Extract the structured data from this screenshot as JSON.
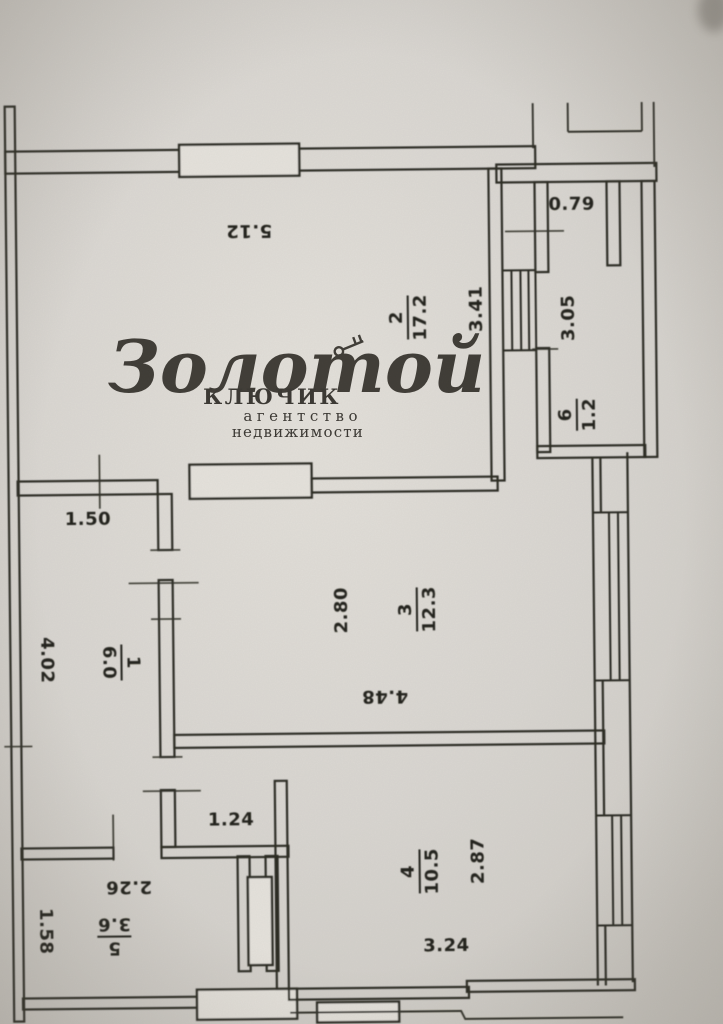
{
  "plan": {
    "rooms": [
      {
        "number": "1",
        "area": "6.0"
      },
      {
        "number": "2",
        "area": "17.2"
      },
      {
        "number": "3",
        "area": "12.3"
      },
      {
        "number": "4",
        "area": "10.5"
      },
      {
        "number": "5",
        "area": "3.6"
      },
      {
        "number": "6",
        "area": "1.2"
      }
    ],
    "dimensions": {
      "room2_width": "5.12",
      "niche_width": "0.79",
      "room2_depth": "3.41",
      "loggia_length": "3.05",
      "hall_niche_width": "1.50",
      "room3_depth": "2.80",
      "room3_width": "4.48",
      "hall_depth": "4.02",
      "corridor_width": "1.24",
      "room5_width": "2.26",
      "room5_depth": "1.58",
      "room4_depth": "2.87",
      "room4_width": "3.24"
    }
  },
  "watermark": {
    "brand_script": "Золотой",
    "brand_word": "КЛЮЧИК",
    "tagline_line1": "агентство",
    "tagline_line2": "недвижимости"
  },
  "colors": {
    "paper": "#d7d4cf",
    "ink": "#2c2a24",
    "watermark_ink": "#34312b"
  }
}
